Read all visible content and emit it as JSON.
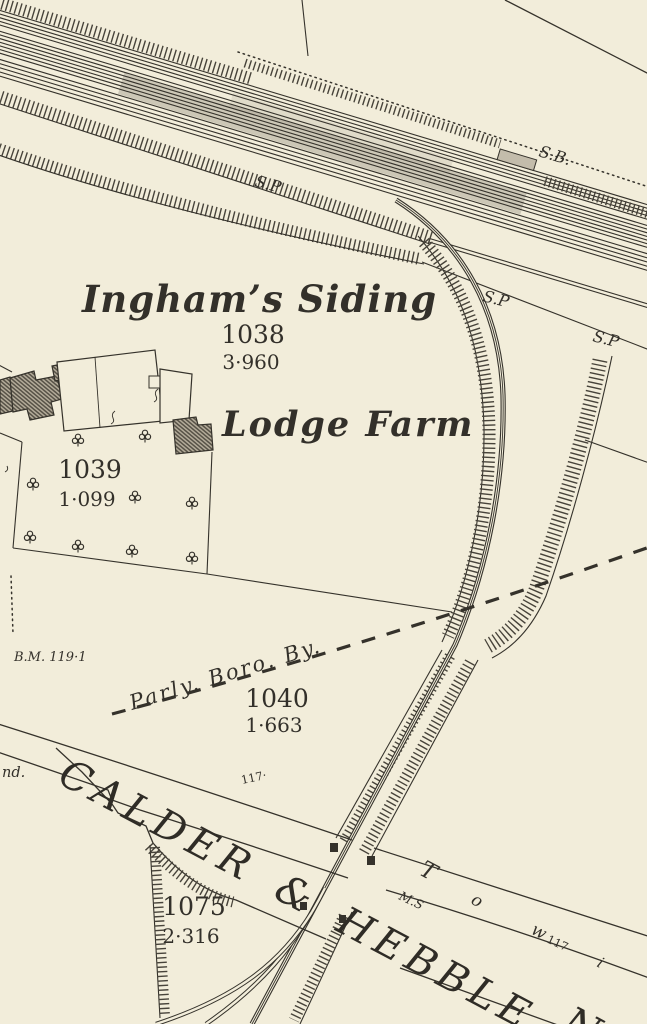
{
  "map": {
    "colors": {
      "paper": "#f2edda",
      "ink": "#35322b",
      "hatch": "#47433a",
      "building_fill": "#b3ab99",
      "signal_box_fill": "#c3bcab"
    },
    "names": {
      "siding": "Ingham’s Siding",
      "farm": "Lodge Farm",
      "canal": "CALDER & HEBBLE",
      "canal_next_word_fragment": "N",
      "parliamentary_boundary": "Parly. Boro. By."
    },
    "labels": {
      "signal_box": "S.B.",
      "signal_post": "S.P",
      "benchmark": "B.M. 119·1",
      "milestone": "M.S",
      "level_canal_upper": "117·",
      "level_towpath": "117",
      "edge_word_fragment": "nd."
    },
    "towpath_letters": {
      "t": "T",
      "o": "o",
      "w": "w",
      "i": "i"
    },
    "parcels": [
      {
        "number": "1038",
        "acreage": "3·960"
      },
      {
        "number": "1039",
        "acreage": "1·099"
      },
      {
        "number": "1040",
        "acreage": "1·663"
      },
      {
        "number": "1075",
        "acreage": "2·316"
      }
    ]
  }
}
